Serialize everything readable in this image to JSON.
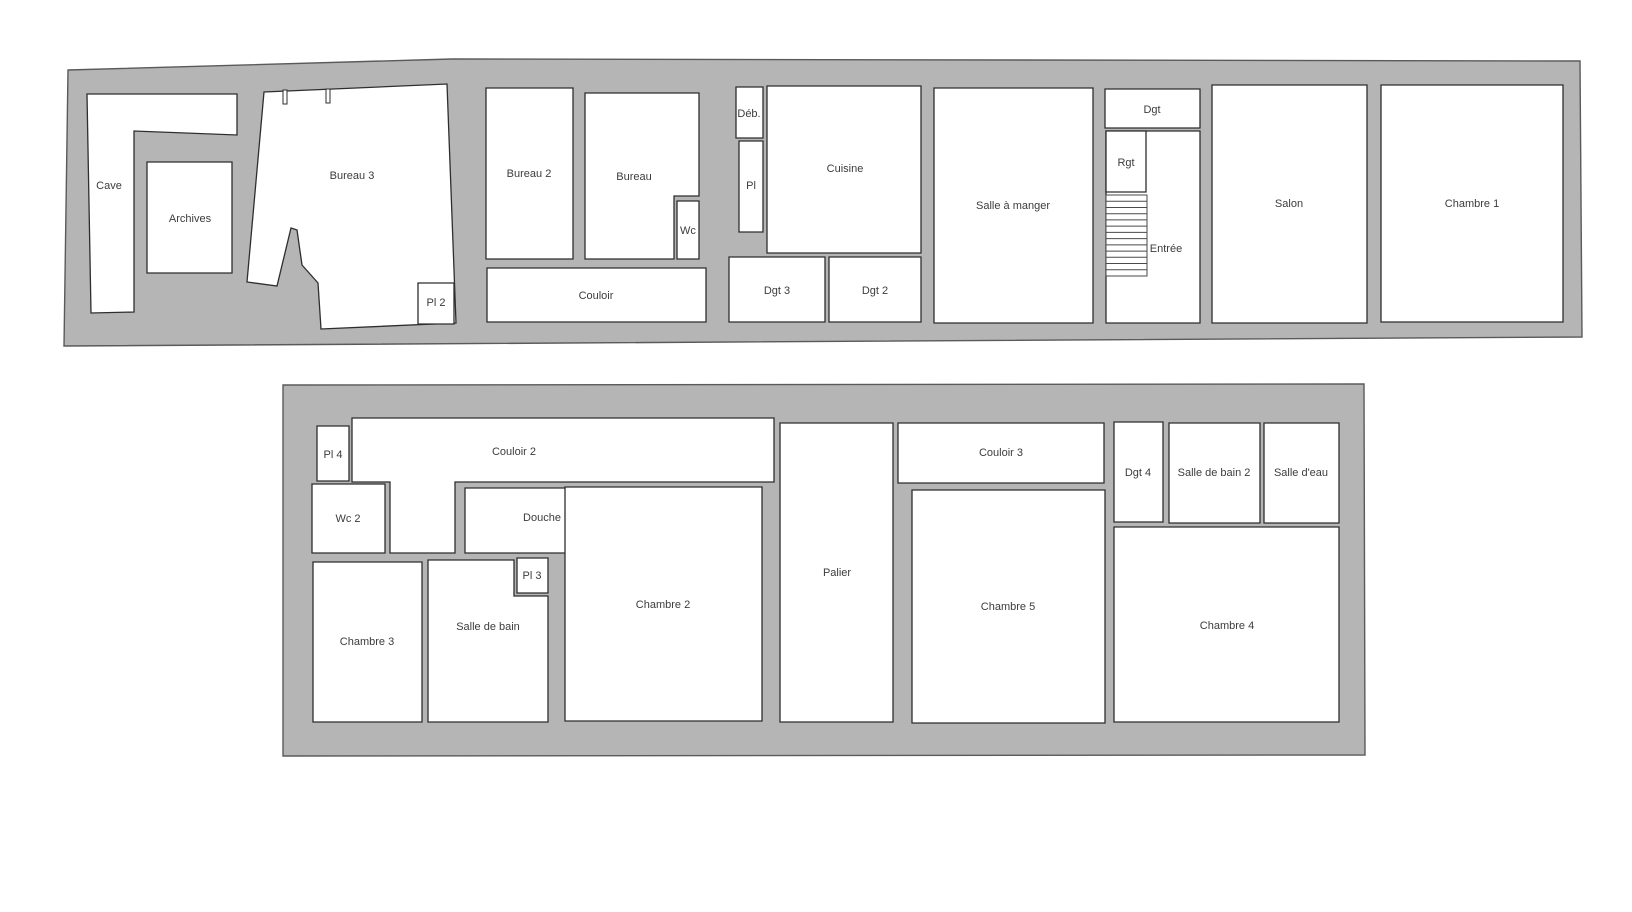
{
  "palette": {
    "wall_fill": "#b5b5b5",
    "wall_stroke": "#5a5a5a",
    "room_fill": "#ffffff",
    "room_stroke": "#2e2e2e",
    "label_color": "#3c3c3c",
    "stair_line": "#4a4a4a"
  },
  "floors": [
    {
      "id": "ground-floor",
      "outer": "68,70 452,59 1580,61 1582,337 64,346",
      "rooms": [
        {
          "id": "cave",
          "label": "Cave",
          "shape": "polygon",
          "points": "87,94 237,94 237,135 134,131 134,312 91,313",
          "label_x": 109,
          "label_y": 186
        },
        {
          "id": "archives",
          "label": "Archives",
          "shape": "polygon",
          "points": "147,162 232,162 232,273 147,273",
          "label_x": 190,
          "label_y": 219
        },
        {
          "id": "bureau-3",
          "label": "Bureau 3",
          "shape": "polygon",
          "points": "264,92 447,84 456,323 321,329 318,283 302,265 297,230 291,228 277,286 247,282",
          "label_x": 352,
          "label_y": 176
        },
        {
          "id": "pl-2",
          "label": "Pl 2",
          "shape": "polygon",
          "points": "418,283 454,283 454,324 418,324",
          "label_x": 436,
          "label_y": 303
        },
        {
          "id": "bureau-2",
          "label": "Bureau 2",
          "shape": "polygon",
          "points": "486,88 573,88 573,259 486,259",
          "label_x": 529,
          "label_y": 174
        },
        {
          "id": "bureau",
          "label": "Bureau",
          "shape": "polygon",
          "points": "585,93 699,93 699,196 674,196 674,259 585,259",
          "label_x": 634,
          "label_y": 177
        },
        {
          "id": "wc",
          "label": "Wc",
          "shape": "polygon",
          "points": "677,201 699,201 699,259 677,259",
          "label_x": 688,
          "label_y": 231
        },
        {
          "id": "couloir",
          "label": "Couloir",
          "shape": "polygon",
          "points": "487,268 706,268 706,322 487,322",
          "label_x": 596,
          "label_y": 296
        },
        {
          "id": "deb",
          "label": "Déb.",
          "shape": "polygon",
          "points": "736,87 763,87 763,138 736,138",
          "label_x": 749,
          "label_y": 114
        },
        {
          "id": "pl",
          "label": "Pl",
          "shape": "polygon",
          "points": "739,141 763,141 763,232 739,232",
          "label_x": 751,
          "label_y": 186
        },
        {
          "id": "cuisine",
          "label": "Cuisine",
          "shape": "polygon",
          "points": "767,86 921,86 921,253 767,253",
          "label_x": 845,
          "label_y": 169
        },
        {
          "id": "dgt-3",
          "label": "Dgt 3",
          "shape": "polygon",
          "points": "729,257 825,257 825,322 729,322",
          "label_x": 777,
          "label_y": 291
        },
        {
          "id": "dgt-2",
          "label": "Dgt 2",
          "shape": "polygon",
          "points": "829,257 921,257 921,322 829,322",
          "label_x": 875,
          "label_y": 291
        },
        {
          "id": "salle-a-manger",
          "label": "Salle à manger",
          "shape": "polygon",
          "points": "934,88 1093,88 1093,323 934,323",
          "label_x": 1013,
          "label_y": 206
        },
        {
          "id": "dgt",
          "label": "Dgt",
          "shape": "polygon",
          "points": "1105,89 1200,89 1200,128 1105,128",
          "label_x": 1152,
          "label_y": 110
        },
        {
          "id": "entree",
          "label": "Entrée",
          "shape": "polygon",
          "points": "1106,131 1200,131 1200,323 1106,323",
          "label_x": 1166,
          "label_y": 249
        },
        {
          "id": "rgt",
          "label": "Rgt",
          "shape": "polygon",
          "points": "1106,131 1146,131 1146,192 1106,192",
          "label_x": 1126,
          "label_y": 163
        },
        {
          "id": "salon",
          "label": "Salon",
          "shape": "polygon",
          "points": "1212,85 1367,85 1367,323 1212,323",
          "label_x": 1289,
          "label_y": 204
        },
        {
          "id": "chambre-1",
          "label": "Chambre 1",
          "shape": "polygon",
          "points": "1381,85 1563,85 1563,322 1381,322",
          "label_x": 1472,
          "label_y": 204
        }
      ],
      "stairs": {
        "x": 1106,
        "y": 195,
        "w": 41,
        "h": 81,
        "treads": 13
      },
      "wall_stubs": [
        {
          "x": 283,
          "y": 90,
          "w": 4,
          "h": 14
        },
        {
          "x": 326,
          "y": 89,
          "w": 4,
          "h": 14
        }
      ]
    },
    {
      "id": "upper-floor",
      "outer": "283,385 1364,384 1365,755 283,756",
      "rooms": [
        {
          "id": "pl-4",
          "label": "Pl 4",
          "shape": "polygon",
          "points": "317,426 349,426 349,481 317,481",
          "label_x": 333,
          "label_y": 455
        },
        {
          "id": "couloir-2",
          "label": "Couloir 2",
          "shape": "polygon",
          "points": "352,418 774,418 774,482 455,482 455,553 390,553 390,482 352,482",
          "label_x": 514,
          "label_y": 452
        },
        {
          "id": "wc-2",
          "label": "Wc 2",
          "shape": "polygon",
          "points": "312,484 385,484 385,553 312,553",
          "label_x": 348,
          "label_y": 519
        },
        {
          "id": "douche",
          "label": "Douche",
          "shape": "path",
          "d": "M 465,488 L 637,488 Q 652,488 652,503 L 652,553 L 465,553 Z",
          "label_x": 542,
          "label_y": 518
        },
        {
          "id": "chambre-3",
          "label": "Chambre 3",
          "shape": "polygon",
          "points": "313,562 422,562 422,722 313,722",
          "label_x": 367,
          "label_y": 642
        },
        {
          "id": "salle-de-bain",
          "label": "Salle de bain",
          "shape": "polygon",
          "points": "428,560 514,560 514,596 548,596 548,722 428,722",
          "label_x": 488,
          "label_y": 627
        },
        {
          "id": "pl-3",
          "label": "Pl 3",
          "shape": "polygon",
          "points": "517,558 548,558 548,593 517,593",
          "label_x": 532,
          "label_y": 576
        },
        {
          "id": "chambre-2",
          "label": "Chambre 2",
          "shape": "polygon",
          "points": "565,487 762,487 762,721 565,721",
          "label_x": 663,
          "label_y": 605
        },
        {
          "id": "palier",
          "label": "Palier",
          "shape": "polygon",
          "points": "780,423 893,423 893,722 780,722",
          "label_x": 837,
          "label_y": 573
        },
        {
          "id": "couloir-3",
          "label": "Couloir 3",
          "shape": "polygon",
          "points": "898,423 1104,423 1104,483 898,483",
          "label_x": 1001,
          "label_y": 453
        },
        {
          "id": "chambre-5",
          "label": "Chambre 5",
          "shape": "polygon",
          "points": "912,490 1105,490 1105,723 912,723",
          "label_x": 1008,
          "label_y": 607
        },
        {
          "id": "dgt-4",
          "label": "Dgt 4",
          "shape": "polygon",
          "points": "1114,422 1163,422 1163,522 1114,522",
          "label_x": 1138,
          "label_y": 473
        },
        {
          "id": "salle-de-bain-2",
          "label": "Salle de bain 2",
          "shape": "polygon",
          "points": "1169,423 1260,423 1260,523 1169,523",
          "label_x": 1214,
          "label_y": 473
        },
        {
          "id": "salle-d-eau",
          "label": "Salle d'eau",
          "shape": "polygon",
          "points": "1264,423 1339,423 1339,523 1264,523",
          "label_x": 1301,
          "label_y": 473
        },
        {
          "id": "chambre-4",
          "label": "Chambre 4",
          "shape": "polygon",
          "points": "1114,527 1339,527 1339,722 1114,722",
          "label_x": 1227,
          "label_y": 626
        }
      ],
      "stairs": null,
      "wall_stubs": []
    }
  ]
}
